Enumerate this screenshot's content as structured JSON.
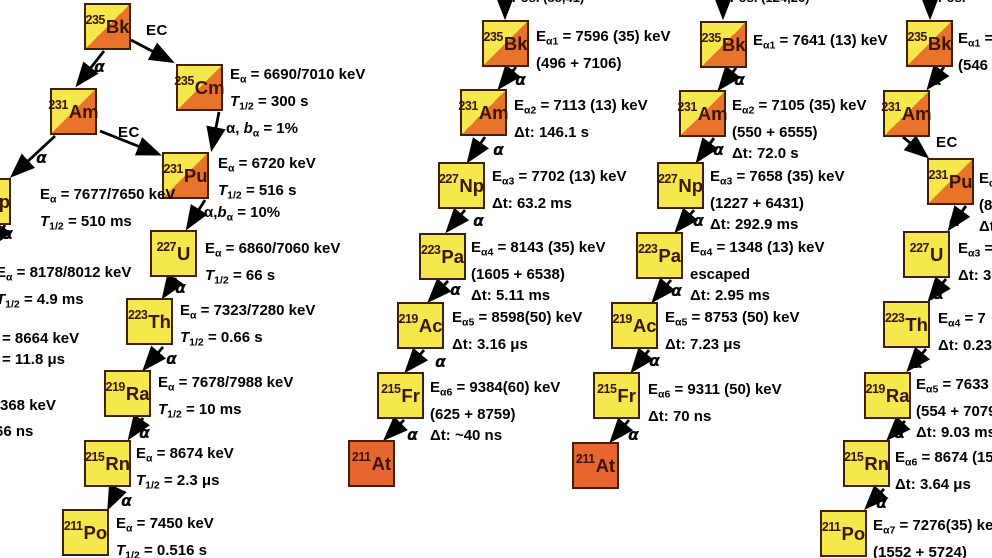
{
  "palette": {
    "yellow": "#f6e74c",
    "orange": "#e8742b",
    "solid_orange": "#e7662f",
    "box_border": "#40200a",
    "nuclide_text": "#3a1404",
    "text": "#000000",
    "background": "#ffffff"
  },
  "panels": [
    {
      "id": "p1",
      "nodes": [
        {
          "mass": "235",
          "symbol": "Bk",
          "x": 84,
          "y": 3,
          "fill": "split"
        },
        {
          "mass": "235",
          "symbol": "Cm",
          "x": 176,
          "y": 64,
          "fill": "split"
        },
        {
          "mass": "231",
          "symbol": "Am",
          "x": 50,
          "y": 88,
          "fill": "split"
        },
        {
          "mass": "231",
          "symbol": "Pu",
          "x": 162,
          "y": 152,
          "fill": "split"
        },
        {
          "mass": "227",
          "symbol": "Np",
          "x": -36,
          "y": 178,
          "fill": "yellow"
        },
        {
          "mass": "227",
          "symbol": "U",
          "x": 150,
          "y": 230,
          "fill": "yellow"
        },
        {
          "mass": "223",
          "symbol": "Th",
          "x": 126,
          "y": 298,
          "fill": "yellow"
        },
        {
          "mass": "219",
          "symbol": "Ra",
          "x": 104,
          "y": 370,
          "fill": "yellow"
        },
        {
          "mass": "215",
          "symbol": "Rn",
          "x": 84,
          "y": 440,
          "fill": "yellow"
        },
        {
          "mass": "211",
          "symbol": "Po",
          "x": 62,
          "y": 509,
          "fill": "yellow"
        }
      ],
      "notes": [
        {
          "x": 230,
          "y": 64,
          "lines": [
            "E_{α} = 6690/7010 keV",
            "*T*_{1/2} = 300 s"
          ]
        },
        {
          "x": 218,
          "y": 153,
          "lines": [
            "E_{α} = 6720 keV",
            "*T*_{1/2} = 516 s"
          ]
        },
        {
          "x": 40,
          "y": 184,
          "lines": [
            "E_{α} = 7677/7650 keV",
            "*T*_{1/2} = 510 ms"
          ]
        },
        {
          "x": -4,
          "y": 262,
          "lines": [
            "E_{α} = 8178/8012 keV",
            "*T*_{1/2} = 4.9 ms"
          ]
        },
        {
          "x": 2,
          "y": 328,
          "lines": [
            "= 8664 keV",
            "= 11.8 μs"
          ]
        },
        {
          "x": 0,
          "y": 395,
          "lines": [
            "368 keV"
          ]
        },
        {
          "x": -5,
          "y": 421,
          "lines": [
            "66 ns"
          ]
        },
        {
          "x": 205,
          "y": 238,
          "lines": [
            "E_{α} = 6860/7060 keV",
            "*T*_{1/2} = 66 s"
          ]
        },
        {
          "x": 180,
          "y": 300,
          "lines": [
            "E_{α} = 7323/7280 keV",
            "*T*_{1/2} = 0.66 s"
          ]
        },
        {
          "x": 158,
          "y": 372,
          "lines": [
            "E_{α} = 7678/7988 keV",
            "*T*_{1/2} = 10 ms"
          ]
        },
        {
          "x": 136,
          "y": 443,
          "lines": [
            "E_{α} = 8674 keV",
            "*T*_{1/2} = 2.3 μs"
          ]
        },
        {
          "x": 116,
          "y": 513,
          "lines": [
            "E_{α} = 7450 keV",
            "*T*_{1/2} = 0.516 s"
          ]
        }
      ],
      "labels": [
        {
          "kind": "ec",
          "text": "EC",
          "x": 146,
          "y": 22
        },
        {
          "kind": "alpha",
          "text": "α",
          "x": 94,
          "y": 57
        },
        {
          "kind": "ec",
          "text": "EC",
          "x": 118,
          "y": 124
        },
        {
          "kind": "alpha",
          "text": "α",
          "x": 36,
          "y": 148
        },
        {
          "kind": "branch",
          "text": "α, *b*_{α} = 1%",
          "x": 226,
          "y": 120
        },
        {
          "kind": "branch",
          "text": "α,*b*_{α} = 10%",
          "x": 204,
          "y": 204
        },
        {
          "kind": "alpha",
          "text": "α",
          "x": 2,
          "y": 224
        },
        {
          "kind": "alpha",
          "text": "α",
          "x": 175,
          "y": 278
        },
        {
          "kind": "alpha",
          "text": "α",
          "x": 166,
          "y": 349
        },
        {
          "kind": "alpha",
          "text": "α",
          "x": 139,
          "y": 423
        },
        {
          "kind": "alpha",
          "text": "α",
          "x": 121,
          "y": 491
        }
      ],
      "arrows": [
        [
          104,
          51,
          78,
          84
        ],
        [
          131,
          40,
          171,
          61
        ],
        [
          219,
          112,
          212,
          148
        ],
        [
          100,
          131,
          158,
          154
        ],
        [
          55,
          136,
          13,
          175
        ],
        [
          205,
          200,
          188,
          227
        ],
        [
          5,
          225,
          -8,
          245
        ],
        [
          176,
          278,
          164,
          296
        ],
        [
          163,
          347,
          145,
          368
        ],
        [
          143,
          418,
          130,
          437
        ],
        [
          117,
          490,
          109,
          507
        ]
      ]
    },
    {
      "id": "p2",
      "nodes": [
        {
          "mass": "235",
          "symbol": "Bk",
          "x": 482,
          "y": 20,
          "fill": "split"
        },
        {
          "mass": "231",
          "symbol": "Am",
          "x": 460,
          "y": 89,
          "fill": "split"
        },
        {
          "mass": "227",
          "symbol": "Np",
          "x": 438,
          "y": 162,
          "fill": "yellow"
        },
        {
          "mass": "223",
          "symbol": "Pa",
          "x": 419,
          "y": 233,
          "fill": "yellow"
        },
        {
          "mass": "219",
          "symbol": "Ac",
          "x": 397,
          "y": 302,
          "fill": "yellow"
        },
        {
          "mass": "215",
          "symbol": "Fr",
          "x": 377,
          "y": 372,
          "fill": "yellow"
        },
        {
          "mass": "211",
          "symbol": "At",
          "x": 348,
          "y": 440,
          "fill": "orange"
        }
      ],
      "notes": [
        {
          "x": 536,
          "y": 26,
          "lines": [
            "E_{α1} = 7596 (35) keV",
            "(496 + 7106)"
          ]
        },
        {
          "x": 514,
          "y": 95,
          "lines": [
            "E_{α2} = 7113 (13) keV",
            "Δt: 146.1 s"
          ]
        },
        {
          "x": 492,
          "y": 166,
          "lines": [
            "E_{α3} = 7702 (13) keV",
            "Δt: 63.2 ms"
          ]
        },
        {
          "x": 471,
          "y": 237,
          "lines": [
            "E_{α4} = 8143 (35) keV",
            "(1605 + 6538)",
            "Δt: 5.11 ms"
          ]
        },
        {
          "x": 452,
          "y": 307,
          "lines": [
            "E_{α5} = 8598(50) keV",
            "Δt: 3.16 μs"
          ]
        },
        {
          "x": 430,
          "y": 377,
          "lines": [
            "E_{α6} = 9384(60) keV",
            "(625 + 8759)",
            "Δt: ~40 ns"
          ]
        }
      ],
      "labels": [
        {
          "kind": "fragment",
          "text": "Pos. (88,41)",
          "x": 512,
          "y": -10
        },
        {
          "kind": "alpha",
          "text": "α",
          "x": 515,
          "y": 70
        },
        {
          "kind": "alpha",
          "text": "α",
          "x": 493,
          "y": 140
        },
        {
          "kind": "alpha",
          "text": "α",
          "x": 473,
          "y": 211
        },
        {
          "kind": "alpha",
          "text": "α",
          "x": 450,
          "y": 280
        },
        {
          "kind": "alpha",
          "text": "α",
          "x": 435,
          "y": 352
        },
        {
          "kind": "alpha",
          "text": "α",
          "x": 407,
          "y": 425
        }
      ],
      "arrows": [
        [
          505,
          0,
          505,
          16
        ],
        [
          516,
          67,
          500,
          87
        ],
        [
          485,
          137,
          469,
          160
        ],
        [
          465,
          210,
          448,
          230
        ],
        [
          448,
          281,
          430,
          300
        ],
        [
          424,
          350,
          407,
          370
        ],
        [
          404,
          420,
          386,
          438
        ]
      ]
    },
    {
      "id": "p3",
      "nodes": [
        {
          "mass": "235",
          "symbol": "Bk",
          "x": 700,
          "y": 21,
          "fill": "split"
        },
        {
          "mass": "231",
          "symbol": "Am",
          "x": 679,
          "y": 90,
          "fill": "split"
        },
        {
          "mass": "227",
          "symbol": "Np",
          "x": 657,
          "y": 162,
          "fill": "yellow"
        },
        {
          "mass": "223",
          "symbol": "Pa",
          "x": 636,
          "y": 232,
          "fill": "yellow"
        },
        {
          "mass": "219",
          "symbol": "Ac",
          "x": 611,
          "y": 302,
          "fill": "yellow"
        },
        {
          "mass": "215",
          "symbol": "Fr",
          "x": 593,
          "y": 372,
          "fill": "yellow"
        },
        {
          "mass": "211",
          "symbol": "At",
          "x": 572,
          "y": 442,
          "fill": "orange"
        }
      ],
      "notes": [
        {
          "x": 753,
          "y": 30,
          "lines": [
            "E_{α1} = 7641 (13) keV"
          ]
        },
        {
          "x": 732,
          "y": 95,
          "lines": [
            "E_{α2} = 7105 (35) keV",
            "(550 + 6555)",
            "Δt: 72.0 s"
          ]
        },
        {
          "x": 710,
          "y": 166,
          "lines": [
            "E_{α3} = 7658 (35) keV",
            "(1227 + 6431)",
            "Δt: 292.9 ms"
          ]
        },
        {
          "x": 690,
          "y": 237,
          "lines": [
            "E_{α4} = 1348 (13) keV",
            "escaped",
            "Δt: 2.95 ms"
          ]
        },
        {
          "x": 665,
          "y": 307,
          "lines": [
            "E_{α5} = 8753 (50) keV",
            "Δt: 7.23 μs"
          ]
        },
        {
          "x": 648,
          "y": 379,
          "lines": [
            "E_{α6} = 9311 (50) keV",
            "Δt: 70 ns"
          ]
        }
      ],
      "labels": [
        {
          "kind": "fragment",
          "text": "Pos. (124,26)",
          "x": 730,
          "y": -10
        },
        {
          "kind": "alpha",
          "text": "α",
          "x": 734,
          "y": 70
        },
        {
          "kind": "alpha",
          "text": "α",
          "x": 713,
          "y": 140
        },
        {
          "kind": "alpha",
          "text": "α",
          "x": 693,
          "y": 211
        },
        {
          "kind": "alpha",
          "text": "α",
          "x": 671,
          "y": 281
        },
        {
          "kind": "alpha",
          "text": "α",
          "x": 649,
          "y": 351
        },
        {
          "kind": "alpha",
          "text": "α",
          "x": 628,
          "y": 425
        }
      ],
      "arrows": [
        [
          723,
          0,
          723,
          16
        ],
        [
          736,
          68,
          720,
          88
        ],
        [
          714,
          138,
          698,
          160
        ],
        [
          694,
          210,
          677,
          230
        ],
        [
          671,
          280,
          654,
          300
        ],
        [
          649,
          350,
          633,
          370
        ],
        [
          629,
          420,
          612,
          440
        ]
      ]
    },
    {
      "id": "p4",
      "nodes": [
        {
          "mass": "235",
          "symbol": "Bk",
          "x": 906,
          "y": 20,
          "fill": "split"
        },
        {
          "mass": "231",
          "symbol": "Am",
          "x": 883,
          "y": 90,
          "fill": "split"
        },
        {
          "mass": "231",
          "symbol": "Pu",
          "x": 927,
          "y": 158,
          "fill": "split"
        },
        {
          "mass": "227",
          "symbol": "U",
          "x": 903,
          "y": 231,
          "fill": "yellow"
        },
        {
          "mass": "223",
          "symbol": "Th",
          "x": 883,
          "y": 301,
          "fill": "yellow"
        },
        {
          "mass": "219",
          "symbol": "Ra",
          "x": 864,
          "y": 372,
          "fill": "yellow"
        },
        {
          "mass": "215",
          "symbol": "Rn",
          "x": 843,
          "y": 440,
          "fill": "yellow"
        },
        {
          "mass": "211",
          "symbol": "Po",
          "x": 820,
          "y": 510,
          "fill": "yellow"
        }
      ],
      "notes": [
        {
          "x": 958,
          "y": 28,
          "lines": [
            "E_{α1} =",
            "(546 +"
          ]
        },
        {
          "x": 979,
          "y": 168,
          "lines": [
            "E_{α2}",
            "(8",
            "Δt:"
          ]
        },
        {
          "x": 958,
          "y": 238,
          "lines": [
            "E_{α3} =",
            "Δt: 30"
          ]
        },
        {
          "x": 938,
          "y": 308,
          "lines": [
            "E_{α4} = 7",
            "Δt: 0.23"
          ]
        },
        {
          "x": 916,
          "y": 374,
          "lines": [
            "E_{α5} = 7633",
            "(554 + 7079",
            "Δt: 9.03 ms"
          ]
        },
        {
          "x": 895,
          "y": 447,
          "lines": [
            "E_{α6} = 8674 (15",
            "Δt: 3.64 μs"
          ]
        },
        {
          "x": 873,
          "y": 515,
          "lines": [
            "E_{α7} = 7276(35) ke",
            "(1552 + 5724)"
          ]
        }
      ],
      "labels": [
        {
          "kind": "fragment",
          "text": "Pos.",
          "x": 938,
          "y": -10
        },
        {
          "kind": "alpha",
          "text": "α",
          "x": 931,
          "y": 70
        },
        {
          "kind": "ec",
          "text": "EC",
          "x": 936,
          "y": 134
        },
        {
          "kind": "alpha",
          "text": "α",
          "x": 949,
          "y": 211
        },
        {
          "kind": "alpha",
          "text": "α",
          "x": 933,
          "y": 284
        },
        {
          "kind": "alpha",
          "text": "α",
          "x": 912,
          "y": 353
        },
        {
          "kind": "alpha",
          "text": "α",
          "x": 894,
          "y": 423
        },
        {
          "kind": "alpha",
          "text": "α",
          "x": 876,
          "y": 493
        }
      ],
      "arrows": [
        [
          930,
          0,
          930,
          16
        ],
        [
          944,
          67,
          929,
          87
        ],
        [
          903,
          137,
          926,
          156
        ],
        [
          966,
          206,
          950,
          228
        ],
        [
          946,
          279,
          930,
          299
        ],
        [
          926,
          349,
          909,
          369
        ],
        [
          905,
          421,
          889,
          438
        ],
        [
          884,
          489,
          867,
          507
        ]
      ]
    }
  ]
}
